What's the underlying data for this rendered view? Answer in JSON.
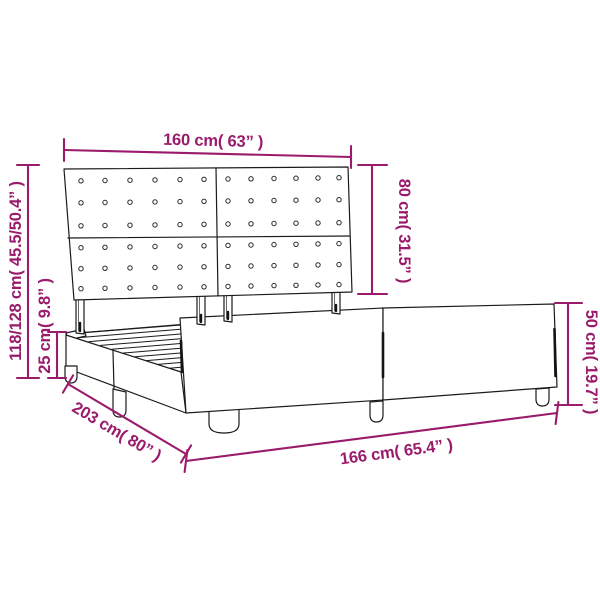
{
  "diagram": {
    "title": "bed frame dimension diagram",
    "accent_color": "#9A1A6B",
    "outline_color": "#1b1b1b",
    "dimensions": {
      "headboard_width": "160 cm( 63” )",
      "headboard_height": "80 cm( 31.5” )",
      "total_height": "118/128 cm( 45.5/50.4” )",
      "side_rail_height": "25 cm( 9.8” )",
      "frame_length": "203 cm( 80” )",
      "frame_width": "166 cm( 65.4” )",
      "footboard_height": "50 cm( 19.7” )"
    }
  }
}
